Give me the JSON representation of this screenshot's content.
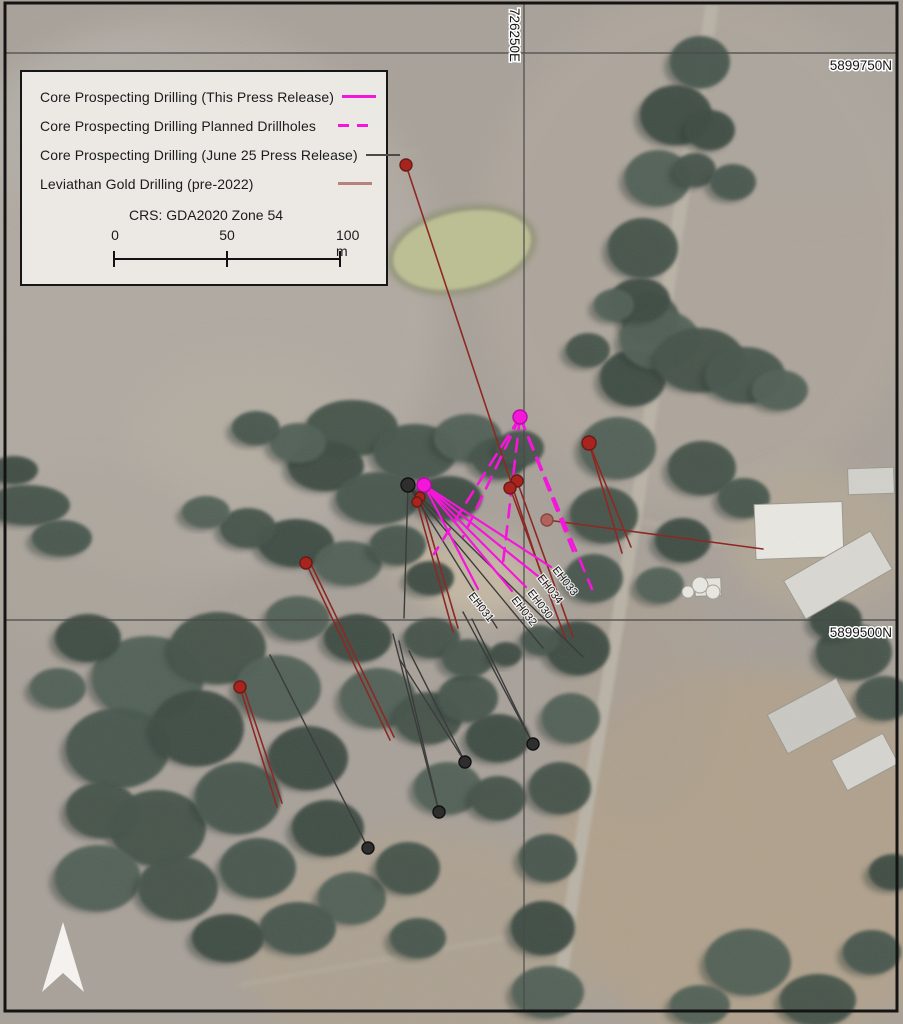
{
  "legend": {
    "items": [
      {
        "label": "Core Prospecting Drilling (This Press Release)",
        "style": "magenta-solid"
      },
      {
        "label": "Core Prospecting Drilling Planned Drillholes",
        "style": "magenta-dashed"
      },
      {
        "label": "Core Prospecting Drilling (June 25 Press Release)",
        "style": "black-solid"
      },
      {
        "label": "Leviathan Gold Drilling (pre-2022)",
        "style": "red-solid"
      }
    ],
    "crs_label": "CRS: GDA2020 Zone 54",
    "scalebar": {
      "tick_labels": [
        "0",
        "50",
        "100 m"
      ]
    }
  },
  "grid": {
    "easting_labels": [
      {
        "text": "726250E",
        "x": 524
      }
    ],
    "northing_labels": [
      {
        "text": "5899750N",
        "y": 53
      },
      {
        "text": "5899500N",
        "y": 620
      }
    ],
    "vertical_lines": [
      524
    ],
    "horizontal_lines": [
      53,
      620
    ]
  },
  "colors": {
    "this_release": "#f416d9",
    "planned": "#f416d9",
    "june25": "#3c3c3c",
    "leviathan": "#8e2823",
    "dot_red": "#a8251f",
    "dot_red_light": "#b0635c",
    "dot_black": "#2e2e2e",
    "frame": "#141414",
    "gridline": "#4a4a4a"
  },
  "drillholes": {
    "labels": [
      {
        "text": "EH031",
        "x": 468,
        "y": 596,
        "angle": 52
      },
      {
        "text": "EH032",
        "x": 511,
        "y": 600,
        "angle": 52
      },
      {
        "text": "EH030",
        "x": 527,
        "y": 593,
        "angle": 52
      },
      {
        "text": "EH034",
        "x": 537,
        "y": 578,
        "angle": 52
      },
      {
        "text": "EH033",
        "x": 552,
        "y": 570,
        "angle": 52
      }
    ],
    "collars": [
      {
        "x": 520,
        "y": 417,
        "r": 7,
        "type": "magenta"
      },
      {
        "x": 424,
        "y": 485,
        "r": 7,
        "type": "magenta"
      },
      {
        "x": 408,
        "y": 485,
        "r": 7,
        "type": "black"
      },
      {
        "x": 368,
        "y": 848,
        "r": 6,
        "type": "black"
      },
      {
        "x": 439,
        "y": 812,
        "r": 6,
        "type": "black"
      },
      {
        "x": 465,
        "y": 762,
        "r": 6,
        "type": "black"
      },
      {
        "x": 533,
        "y": 744,
        "r": 6,
        "type": "black"
      },
      {
        "x": 406,
        "y": 165,
        "r": 6,
        "type": "red"
      },
      {
        "x": 589,
        "y": 443,
        "r": 7,
        "type": "red"
      },
      {
        "x": 517,
        "y": 481,
        "r": 6,
        "type": "red"
      },
      {
        "x": 510,
        "y": 488,
        "r": 6,
        "type": "red"
      },
      {
        "x": 420,
        "y": 497,
        "r": 5,
        "type": "red"
      },
      {
        "x": 417,
        "y": 502,
        "r": 5,
        "type": "red"
      },
      {
        "x": 547,
        "y": 520,
        "r": 6,
        "type": "red-light"
      },
      {
        "x": 306,
        "y": 563,
        "r": 6,
        "type": "red"
      },
      {
        "x": 240,
        "y": 687,
        "r": 6,
        "type": "red"
      }
    ],
    "traces": {
      "this_release": [
        [
          424,
          485,
          551,
          567
        ],
        [
          424,
          485,
          539,
          577
        ],
        [
          424,
          485,
          526,
          587
        ],
        [
          424,
          485,
          512,
          591
        ],
        [
          424,
          485,
          478,
          589
        ]
      ],
      "planned": [
        [
          520,
          417,
          434,
          554
        ],
        [
          520,
          417,
          463,
          537
        ],
        [
          520,
          417,
          503,
          563
        ],
        [
          520,
          417,
          573,
          551
        ],
        [
          520,
          417,
          592,
          589
        ]
      ],
      "june25": [
        [
          408,
          485,
          404,
          618
        ],
        [
          408,
          485,
          497,
          628
        ],
        [
          408,
          485,
          543,
          648
        ],
        [
          408,
          485,
          583,
          657
        ],
        [
          270,
          655,
          368,
          848
        ],
        [
          393,
          634,
          439,
          812
        ],
        [
          399,
          641,
          439,
          812
        ],
        [
          400,
          660,
          465,
          762
        ],
        [
          409,
          651,
          465,
          762
        ],
        [
          463,
          612,
          533,
          744
        ],
        [
          472,
          619,
          533,
          744
        ]
      ],
      "leviathan": [
        [
          406,
          165,
          540,
          570
        ],
        [
          589,
          443,
          622,
          553
        ],
        [
          589,
          443,
          631,
          547
        ],
        [
          517,
          481,
          573,
          637
        ],
        [
          510,
          488,
          566,
          640
        ],
        [
          420,
          497,
          458,
          628
        ],
        [
          417,
          502,
          453,
          632
        ],
        [
          547,
          520,
          763,
          549
        ],
        [
          306,
          563,
          390,
          740
        ],
        [
          309,
          560,
          394,
          737
        ],
        [
          240,
          687,
          277,
          807
        ],
        [
          243,
          686,
          282,
          803
        ]
      ]
    }
  },
  "north_arrow": {
    "points": "63,922 84,992 63,973 42,992",
    "color": "#f7f5f1"
  },
  "map_features": {
    "base_color": "#a8a199",
    "patches": [
      [
        180,
        300,
        260,
        280,
        "#b2aca4",
        0.8
      ],
      [
        700,
        250,
        220,
        260,
        "#b0a89d",
        0.7
      ],
      [
        760,
        860,
        210,
        190,
        "#b3a188",
        0.75
      ],
      [
        420,
        950,
        180,
        120,
        "#b0a28c",
        0.6
      ],
      [
        480,
        580,
        60,
        40,
        "#c9bca6",
        0.85
      ],
      [
        430,
        560,
        40,
        25,
        "#c2b59f",
        0.8
      ],
      [
        250,
        430,
        120,
        80,
        "#b5aea2",
        0.6
      ],
      [
        90,
        560,
        120,
        90,
        "#aca69c",
        0.6
      ],
      [
        820,
        540,
        90,
        70,
        "#b9ab94",
        0.6
      ],
      [
        640,
        700,
        80,
        120,
        "#ab9f8e",
        0.5
      ],
      [
        120,
        130,
        140,
        90,
        "#b4b0a9",
        0.6
      ],
      [
        800,
        120,
        120,
        90,
        "#aba69e",
        0.5
      ]
    ],
    "road": {
      "path": "M712,5 L695,120 L672,260 L655,380 L638,500 L618,620 L598,740 L575,880 L558,1000 L552,1018",
      "color": "#b9b2a6",
      "width": 13
    },
    "tracks": [
      {
        "path": "M240,985 L560,928",
        "width": 5,
        "opacity": 0.55
      },
      {
        "path": "M5,210 C150,150 300,170 420,150",
        "width": 4,
        "opacity": 0.35
      },
      {
        "path": "M640,520 L720,545 L762,540",
        "width": 8,
        "opacity": 0.5
      }
    ],
    "track_color": "#b5ac9e",
    "pond": {
      "cx": 462,
      "cy": 250,
      "rx": 70,
      "ry": 38,
      "rot": -12,
      "fill": "#bcbf92",
      "rim": "#8f9274"
    },
    "buildings": [
      [
        755,
        503,
        88,
        55,
        -2,
        "#e9e7e1"
      ],
      [
        788,
        553,
        100,
        44,
        -30,
        "#d9d7d1"
      ],
      [
        848,
        468,
        46,
        26,
        -2,
        "#d2d0ca"
      ],
      [
        773,
        694,
        78,
        44,
        -28,
        "#cac8c2"
      ],
      [
        836,
        745,
        58,
        34,
        -28,
        "#d6d4ce"
      ],
      [
        695,
        578,
        26,
        18,
        -2,
        "#e6e4de"
      ]
    ],
    "tanks": [
      [
        700,
        585,
        8
      ],
      [
        713,
        592,
        7
      ],
      [
        688,
        592,
        6
      ]
    ],
    "tree_palette": [
      "#47564d",
      "#3d4b43",
      "#516056",
      "#44524a"
    ],
    "trees": [
      [
        700,
        62,
        30,
        26
      ],
      [
        676,
        115,
        36,
        30
      ],
      [
        658,
        178,
        33,
        28
      ],
      [
        643,
        248,
        35,
        30
      ],
      [
        650,
        318,
        29,
        25
      ],
      [
        633,
        378,
        33,
        28
      ],
      [
        618,
        448,
        38,
        31
      ],
      [
        604,
        515,
        34,
        28
      ],
      [
        594,
        578,
        29,
        24
      ],
      [
        578,
        648,
        32,
        27
      ],
      [
        571,
        718,
        29,
        25
      ],
      [
        560,
        788,
        31,
        26
      ],
      [
        548,
        858,
        29,
        24
      ],
      [
        543,
        928,
        32,
        27
      ],
      [
        548,
        992,
        36,
        26
      ],
      [
        695,
        170,
        21,
        17
      ],
      [
        733,
        182,
        23,
        18
      ],
      [
        710,
        130,
        25,
        20
      ],
      [
        660,
        340,
        40,
        30
      ],
      [
        700,
        360,
        45,
        32
      ],
      [
        745,
        375,
        40,
        28
      ],
      [
        640,
        300,
        30,
        22
      ],
      [
        780,
        390,
        28,
        20
      ],
      [
        702,
        468,
        34,
        27
      ],
      [
        744,
        498,
        26,
        20
      ],
      [
        683,
        540,
        28,
        22
      ],
      [
        660,
        585,
        24,
        18
      ],
      [
        854,
        652,
        38,
        28
      ],
      [
        884,
        698,
        28,
        22
      ],
      [
        836,
        620,
        26,
        20
      ],
      [
        748,
        962,
        43,
        33
      ],
      [
        818,
        1000,
        38,
        26
      ],
      [
        872,
        952,
        29,
        22
      ],
      [
        893,
        872,
        24,
        18
      ],
      [
        700,
        1005,
        30,
        20
      ],
      [
        352,
        428,
        46,
        28
      ],
      [
        415,
        452,
        42,
        28
      ],
      [
        326,
        466,
        38,
        25
      ],
      [
        468,
        438,
        34,
        24
      ],
      [
        500,
        458,
        28,
        21
      ],
      [
        378,
        498,
        42,
        26
      ],
      [
        448,
        498,
        34,
        22
      ],
      [
        298,
        443,
        28,
        20
      ],
      [
        520,
        448,
        24,
        18
      ],
      [
        256,
        428,
        24,
        17
      ],
      [
        296,
        543,
        38,
        24
      ],
      [
        348,
        563,
        34,
        22
      ],
      [
        248,
        528,
        28,
        20
      ],
      [
        398,
        545,
        28,
        20
      ],
      [
        430,
        578,
        24,
        17
      ],
      [
        206,
        512,
        24,
        16
      ],
      [
        28,
        505,
        42,
        20
      ],
      [
        62,
        538,
        30,
        18
      ],
      [
        14,
        470,
        24,
        14
      ],
      [
        148,
        678,
        56,
        42
      ],
      [
        218,
        648,
        48,
        36
      ],
      [
        118,
        748,
        52,
        40
      ],
      [
        198,
        728,
        46,
        38
      ],
      [
        278,
        688,
        43,
        33
      ],
      [
        158,
        828,
        48,
        38
      ],
      [
        238,
        798,
        43,
        36
      ],
      [
        308,
        758,
        40,
        32
      ],
      [
        98,
        878,
        43,
        33
      ],
      [
        178,
        888,
        40,
        32
      ],
      [
        258,
        868,
        38,
        30
      ],
      [
        328,
        828,
        36,
        28
      ],
      [
        352,
        898,
        34,
        26
      ],
      [
        408,
        868,
        32,
        26
      ],
      [
        298,
        928,
        38,
        26
      ],
      [
        228,
        938,
        36,
        24
      ],
      [
        378,
        698,
        38,
        30
      ],
      [
        428,
        718,
        34,
        26
      ],
      [
        468,
        698,
        30,
        24
      ],
      [
        498,
        738,
        32,
        24
      ],
      [
        448,
        788,
        34,
        26
      ],
      [
        498,
        798,
        28,
        22
      ],
      [
        418,
        938,
        28,
        20
      ],
      [
        358,
        638,
        34,
        24
      ],
      [
        298,
        618,
        32,
        22
      ],
      [
        432,
        638,
        28,
        20
      ],
      [
        468,
        658,
        26,
        19
      ],
      [
        88,
        638,
        33,
        24
      ],
      [
        58,
        688,
        28,
        20
      ],
      [
        102,
        810,
        36,
        28
      ],
      [
        540,
        640,
        19,
        15
      ],
      [
        506,
        654,
        16,
        12
      ],
      [
        614,
        305,
        20,
        16
      ],
      [
        588,
        350,
        22,
        17
      ]
    ]
  }
}
